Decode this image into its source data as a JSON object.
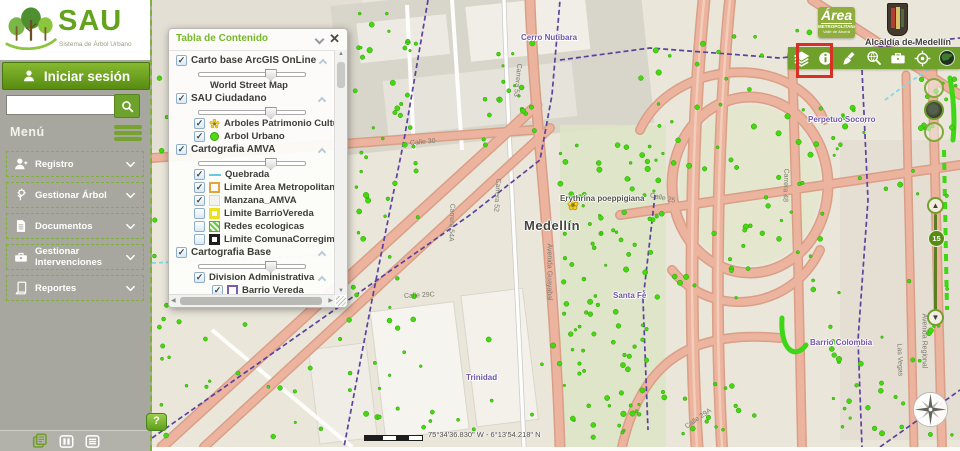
{
  "app": {
    "title": "SAU",
    "tagline": "Sistema de Árbol Urbano"
  },
  "colors": {
    "accent_green": "#76a22e",
    "toolbar_green": "#6fa02b",
    "title_green": "#76b82a",
    "highlight_red": "#d93025",
    "purple_label": "#7053ab"
  },
  "sidebar": {
    "login_label": "Iniciar sesión",
    "search_placeholder": "",
    "search_value": "",
    "menu_title": "Menú",
    "items": [
      {
        "label": "Registro",
        "icon": "user-add-icon"
      },
      {
        "label": "Gestionar Árbol",
        "icon": "tree-settings-icon"
      },
      {
        "label": "Documentos",
        "icon": "document-icon"
      },
      {
        "label": "Gestionar Intervenciones",
        "icon": "toolbox-icon"
      },
      {
        "label": "Reportes",
        "icon": "report-pages-icon"
      }
    ],
    "footer_icons": [
      "pages-icon",
      "columns-icon",
      "list-icon"
    ]
  },
  "toc": {
    "title": "Tabla de Contenido",
    "rows": [
      {
        "kind": "group",
        "label": "Carto base ArcGIS OnLine",
        "checked": true
      },
      {
        "kind": "slider"
      },
      {
        "kind": "plain",
        "label": "World Street Map"
      },
      {
        "kind": "group",
        "label": "SAU Ciudadano",
        "checked": true
      },
      {
        "kind": "slider"
      },
      {
        "kind": "layer",
        "label": "Arboles Patrimonio Cultural",
        "checked": true,
        "swatch": "flower"
      },
      {
        "kind": "layer",
        "label": "Arbol Urbano",
        "checked": true,
        "swatch": "green-dot"
      },
      {
        "kind": "group",
        "label": "Cartografia AMVA",
        "checked": true
      },
      {
        "kind": "slider"
      },
      {
        "kind": "layer",
        "label": "Quebrada",
        "checked": true,
        "swatch": "blue-line"
      },
      {
        "kind": "layer",
        "label": "Limite Area Metropolitana",
        "checked": true,
        "swatch": "orange-dashed"
      },
      {
        "kind": "layer",
        "label": "Manzana_AMVA",
        "checked": true,
        "swatch": "plain"
      },
      {
        "kind": "layer",
        "label": "Limite BarrioVereda",
        "checked": false,
        "swatch": "yellow"
      },
      {
        "kind": "layer",
        "label": "Redes ecologicas",
        "checked": false,
        "swatch": "green-grid"
      },
      {
        "kind": "layer",
        "label": "Limite ComunaCorregimiento",
        "checked": false,
        "swatch": "black"
      },
      {
        "kind": "group",
        "label": "Cartografia Base",
        "checked": true
      },
      {
        "kind": "slider"
      },
      {
        "kind": "subgroup",
        "label": "Division Administrativa",
        "checked": true
      },
      {
        "kind": "sublayer",
        "label": "Barrio Vereda",
        "checked": true,
        "swatch": "purple-dashed"
      },
      {
        "kind": "subgroup",
        "label": "Referentes",
        "checked": true
      }
    ]
  },
  "toolbar": {
    "buttons": [
      {
        "icon": "layers-icon",
        "highlighted": true
      },
      {
        "icon": "info-icon"
      },
      {
        "icon": "broom-icon"
      },
      {
        "icon": "search-globe-icon"
      },
      {
        "icon": "briefcase-icon"
      },
      {
        "icon": "locate-icon"
      },
      {
        "icon": "globe-icon"
      }
    ]
  },
  "branding": {
    "area_logo": {
      "line1": "Área",
      "line2": "METROPOLITANA",
      "line3": "Valle de Aburrá"
    },
    "alcaldia_label": "Alcaldía de Medellín"
  },
  "map": {
    "zoom_level": "15",
    "zoom_in_glyph": "▲",
    "zoom_out_glyph": "▼",
    "coordinates": "75°34'36.830\" W  -  6°13'54.218\" N",
    "help_label": "?",
    "labels": [
      {
        "kind": "city",
        "text": "Medellín",
        "x": 372,
        "y": 218,
        "rot": 0
      },
      {
        "kind": "species",
        "text": "Erythrina poeppigiana",
        "x": 408,
        "y": 194,
        "rot": 0
      },
      {
        "kind": "place",
        "text": "Cerro Nutibara",
        "x": 369,
        "y": 33,
        "rot": 0
      },
      {
        "kind": "place",
        "text": "Perpetuo Socorro",
        "x": 656,
        "y": 115,
        "rot": 0
      },
      {
        "kind": "place",
        "text": "Santa Fé",
        "x": 461,
        "y": 291,
        "rot": 0
      },
      {
        "kind": "place",
        "text": "Barrio Colombia",
        "x": 658,
        "y": 338,
        "rot": 0
      },
      {
        "kind": "place",
        "text": "Trinidad",
        "x": 314,
        "y": 373,
        "rot": 0
      },
      {
        "kind": "street",
        "text": "Carrera 53",
        "x": 367,
        "y": 60,
        "rot": 96
      },
      {
        "kind": "street",
        "text": "Calle 30",
        "x": 258,
        "y": 140,
        "rot": -5
      },
      {
        "kind": "street",
        "text": "Carrera 52",
        "x": 346,
        "y": 175,
        "rot": 94
      },
      {
        "kind": "street",
        "text": "Carrera 54A",
        "x": 300,
        "y": 200,
        "rot": 92
      },
      {
        "kind": "street",
        "text": "Calle 29C",
        "x": 252,
        "y": 293,
        "rot": -3
      },
      {
        "kind": "street",
        "text": "Avenida Guayabal",
        "x": 397,
        "y": 240,
        "rot": 90
      },
      {
        "kind": "street",
        "text": "Calle 25",
        "x": 498,
        "y": 192,
        "rot": 13
      },
      {
        "kind": "street",
        "text": "Carrera 48",
        "x": 634,
        "y": 165,
        "rot": 92
      },
      {
        "kind": "street",
        "text": "Avenida Regional",
        "x": 772,
        "y": 310,
        "rot": 90
      },
      {
        "kind": "street",
        "text": "Las Vegas",
        "x": 747,
        "y": 340,
        "rot": 88
      },
      {
        "kind": "street",
        "text": "Calle 29A",
        "x": 534,
        "y": 424,
        "rot": -35
      }
    ]
  }
}
